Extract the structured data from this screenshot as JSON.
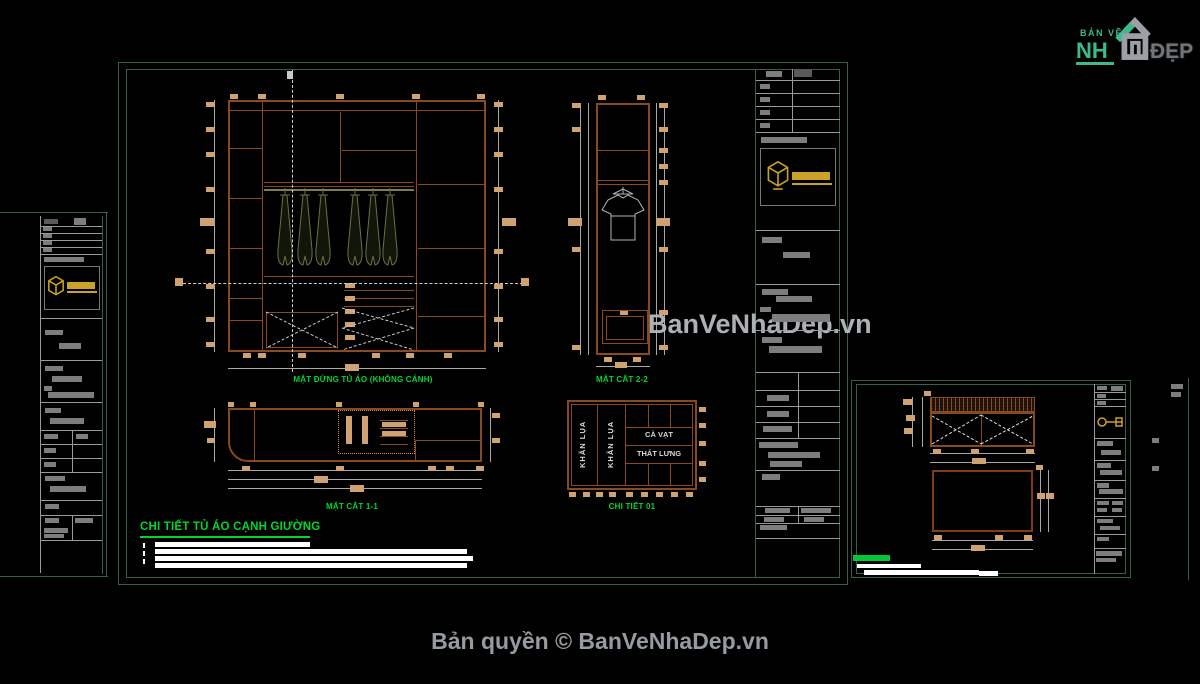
{
  "page": {
    "watermark_text": "BanVeNhaDep.vn",
    "footer_text": "Bản quyền © BanVeNhaDep.vn"
  },
  "site_logo": {
    "top_text": "BẢN VẼ",
    "name_left": "NH",
    "name_right": "ĐẸP"
  },
  "main_sheet": {
    "sheet_title": "CHI TIẾT TỦ ÁO CẠNH GIƯỜNG",
    "labels": {
      "elevation": "MẶT ĐỨNG TỦ ÁO (KHÔNG CÁNH)",
      "section_2_2": "MẶT CẮT 2-2",
      "section_1_1": "MẶT CẮT 1-1",
      "detail_01": "CHI TIẾT 01"
    },
    "detail_01_cells": {
      "left_column_1": "KHĂN LỤA",
      "left_column_2": "KHĂN LỤA",
      "shelf_top": "CÀ VẠT",
      "shelf_bottom": "THẮT LƯNG"
    }
  },
  "colors": {
    "frame_teal": "#33604f",
    "line_brown": "#8a4a1f",
    "tan_block": "#cfa272",
    "label_green": "#00d632",
    "highlight_green": "#00c838",
    "gold": "#c9a227",
    "redaction_gray": "#7d7d7d",
    "watermark_gray": "#b7bbbf",
    "footer_gray": "#969ba1",
    "logo_green": "#3cba8a",
    "logo_gray": "#70757a"
  }
}
